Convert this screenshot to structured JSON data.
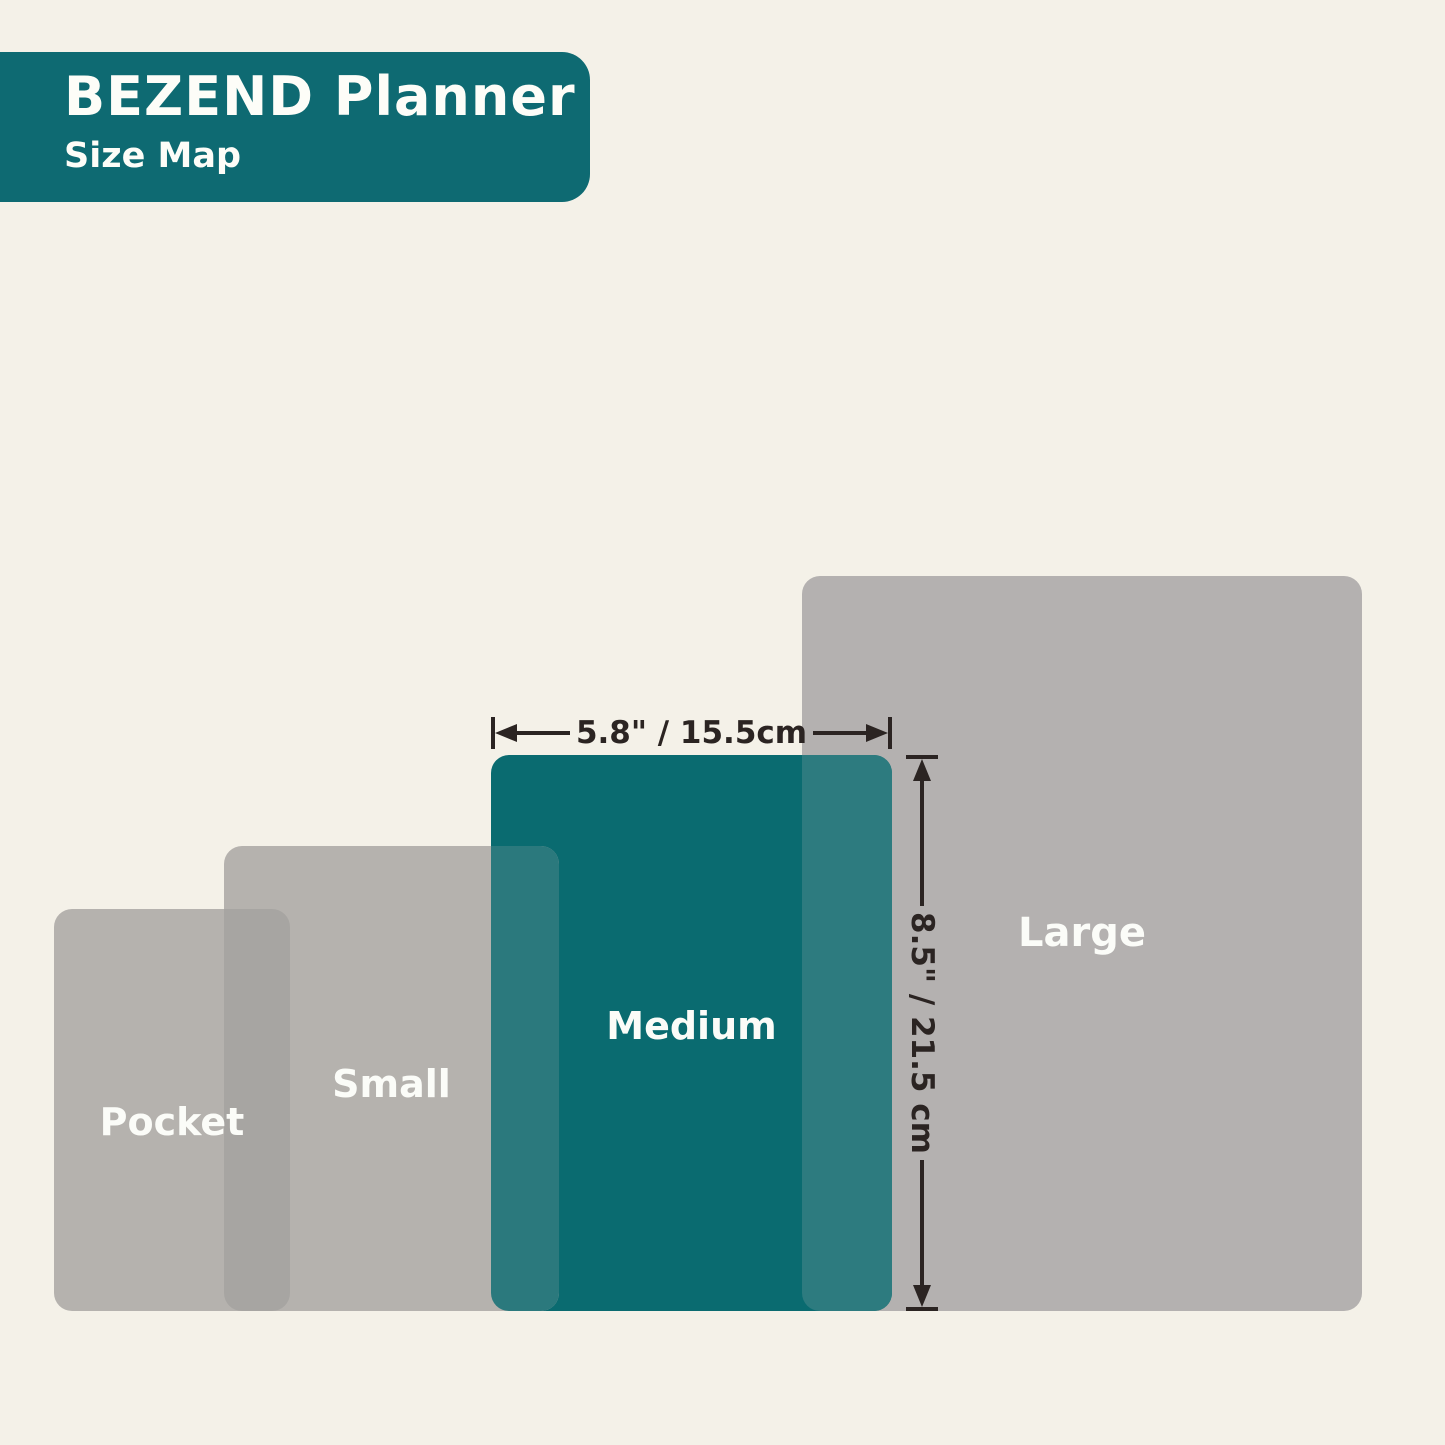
{
  "header": {
    "title": "BEZEND Planner",
    "subtitle": "Size Map"
  },
  "sizes": [
    {
      "id": "pocket",
      "label": "Pocket",
      "highlighted": false
    },
    {
      "id": "small",
      "label": "Small",
      "highlighted": false
    },
    {
      "id": "medium",
      "label": "Medium",
      "highlighted": true
    },
    {
      "id": "large",
      "label": "Large",
      "highlighted": false
    }
  ],
  "dimension_annotations": {
    "medium_width": "5.8\" / 15.5cm",
    "medium_height": "8.5\" / 21.5 cm"
  },
  "colors": {
    "bg": "#f4f1e8",
    "header_bg": "#0e6a72",
    "header_text": "#fdfdf8",
    "rect_teal": "#0a6b70",
    "rect_gray": "#b5b2ae",
    "rect_gray_large": "#b4b1b0",
    "overlap_gray": "#a7a5a2",
    "overlap_teal_small": "#2b797d",
    "overlap_teal_large": "#2d7b7f",
    "label_text": "#fbfcf8",
    "dim_color": "#2b2422"
  }
}
